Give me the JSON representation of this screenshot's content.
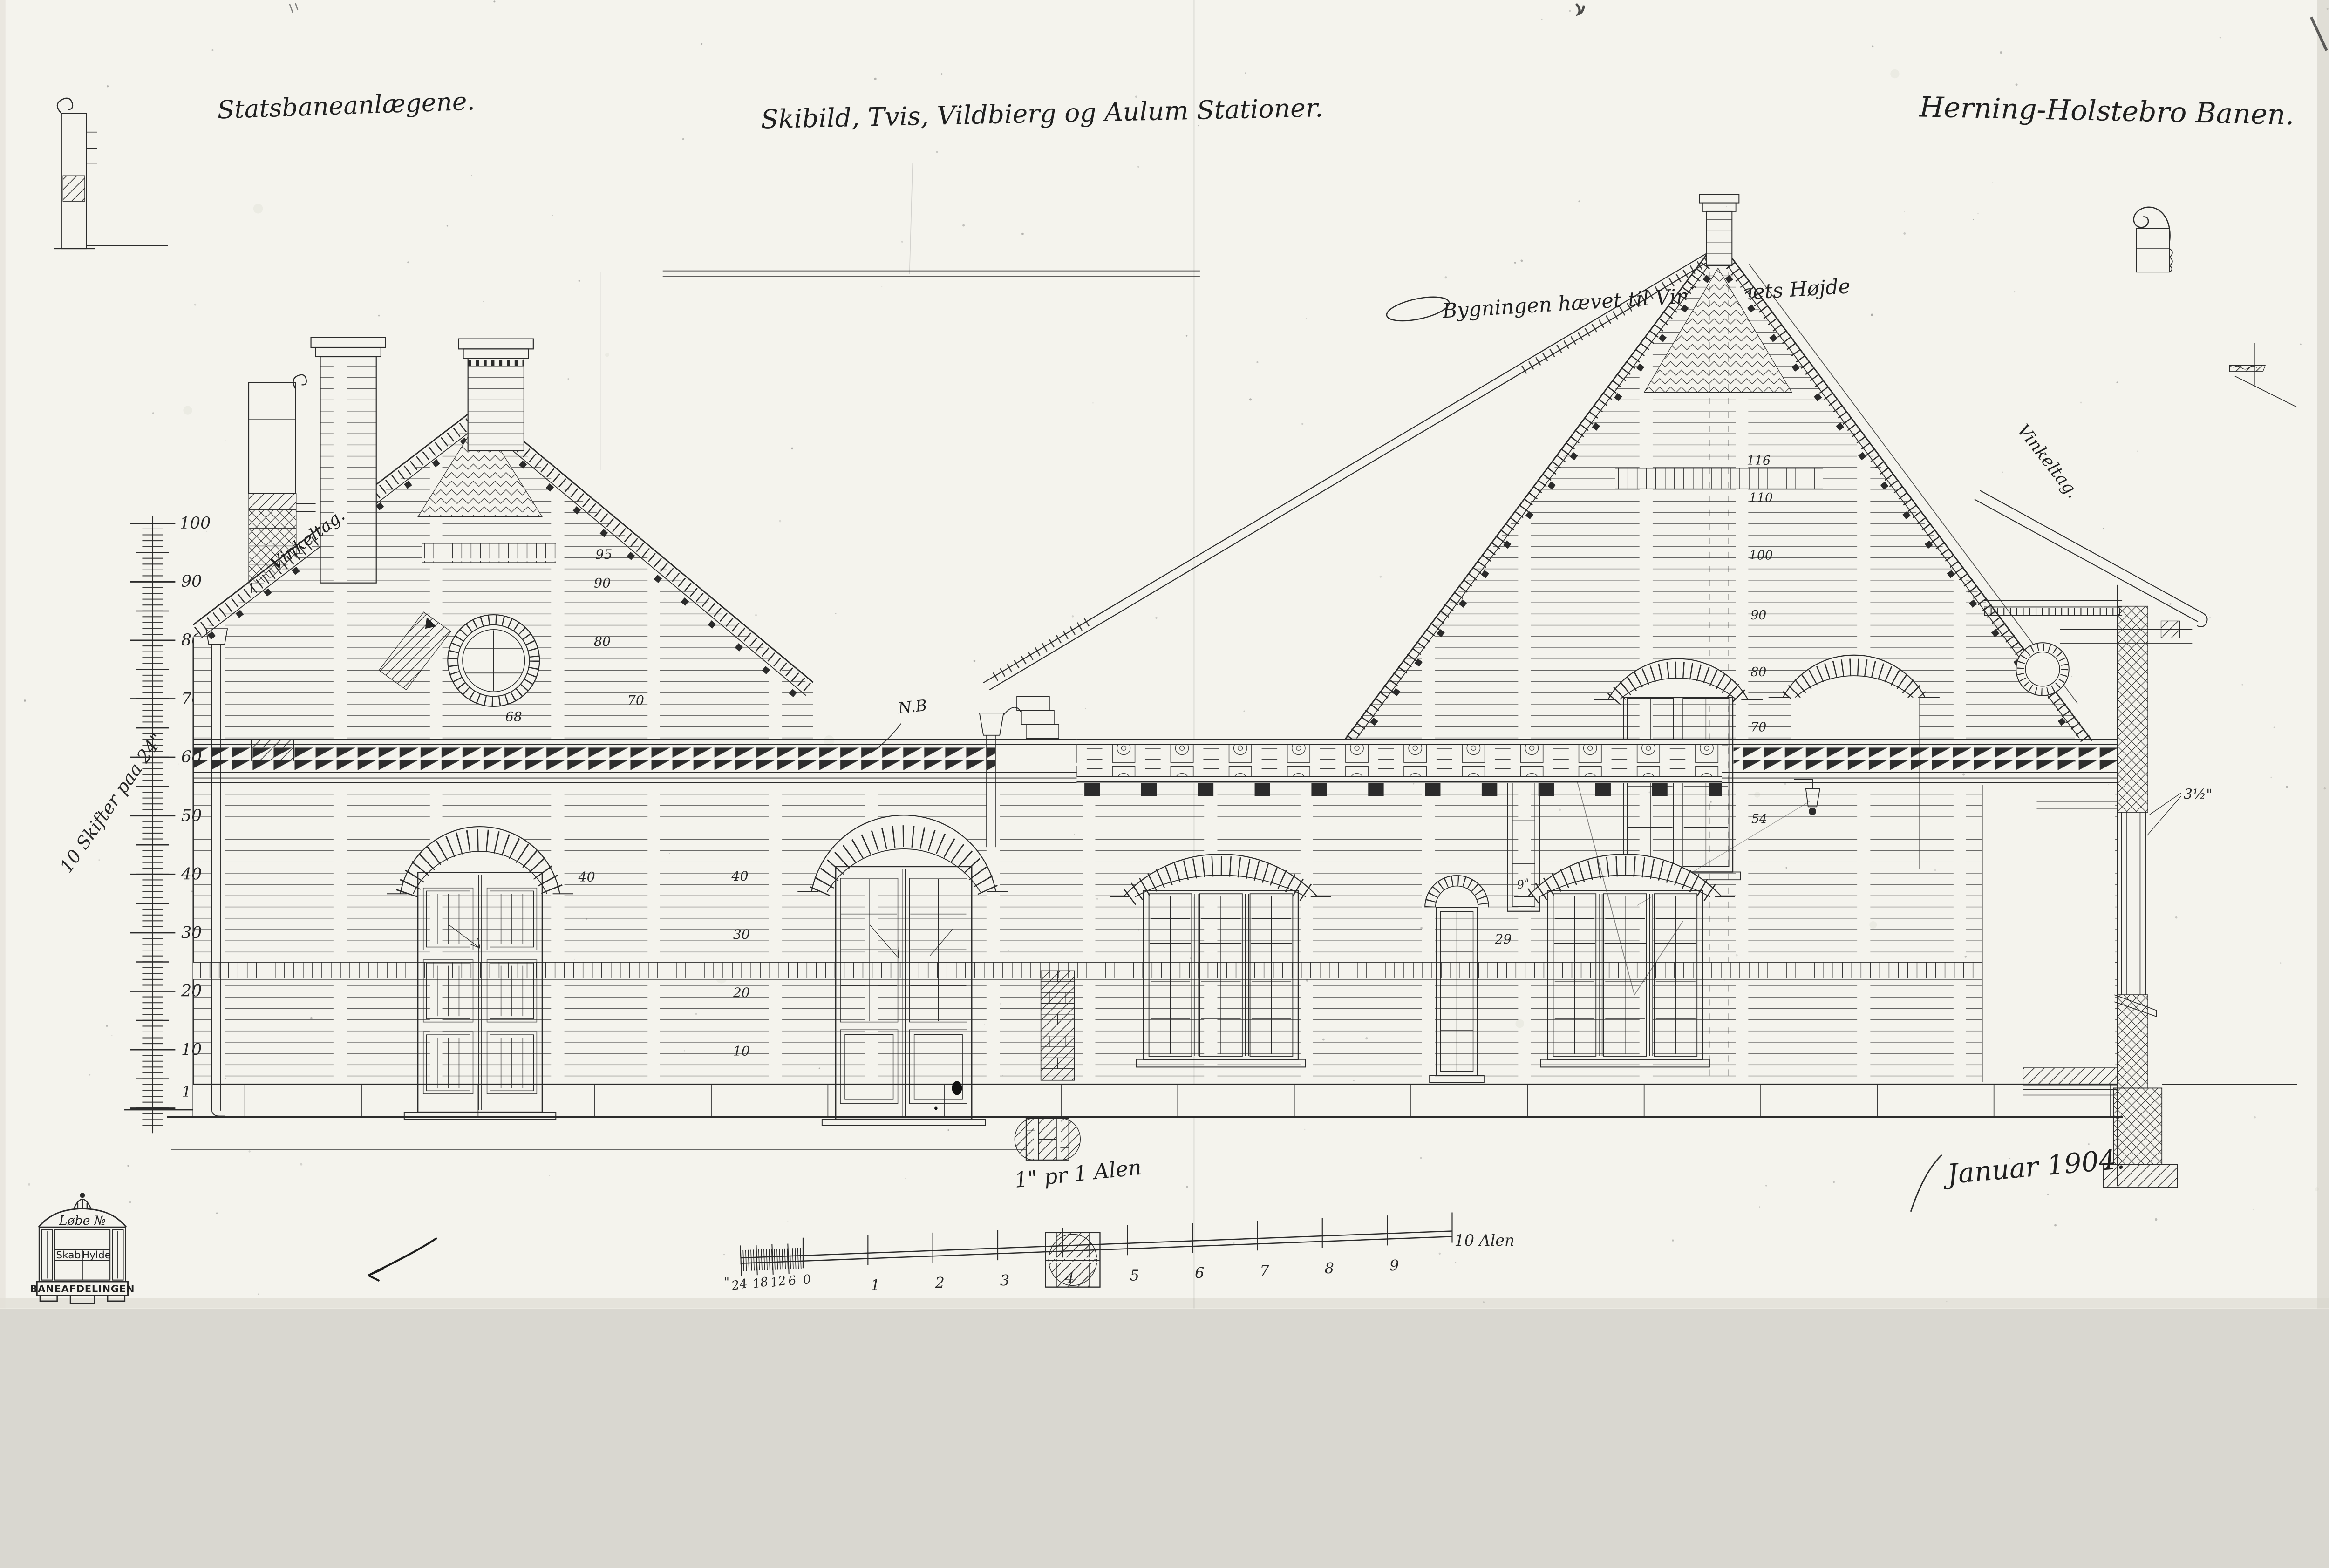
{
  "titles": {
    "left": "Statsbaneanlægene.",
    "center": "Skibild, Tvis, Vildbierg og Aulum Stationer.",
    "right": "Herning-Holstebro Banen."
  },
  "annotations": {
    "raised": "Bygningen hævet til Vinkeltagets Højde",
    "roof_left": "Vinkeltag.",
    "roof_right": "Vinkeltag.",
    "nb": "N.B",
    "scale_note": "1\" pr 1 Alen",
    "date": "Januar 1904."
  },
  "ruler": {
    "note": "10 Skifter paa 24\"",
    "labels": [
      "100",
      "90",
      "80",
      "70",
      "60",
      "50",
      "40",
      "30",
      "20",
      "10",
      "1",
      "0"
    ]
  },
  "scalebar": {
    "inch_mark": "\"",
    "inch": [
      "24",
      "18",
      "12",
      "6",
      "0"
    ],
    "alen": [
      "1",
      "2",
      "3",
      "4",
      "5",
      "6",
      "7",
      "8",
      "9"
    ],
    "end": "10 Alen"
  },
  "numbers": {
    "left_gable": [
      "95",
      "90",
      "80",
      "70",
      "68"
    ],
    "wall": [
      "40",
      "40",
      "30",
      "20",
      "10"
    ],
    "window": "29",
    "lamp": "54",
    "right_gable": [
      "116",
      "110",
      "100",
      "90",
      "80",
      "70"
    ]
  },
  "dims": {
    "frame": "3½\"",
    "side": "9\""
  },
  "stamp": {
    "top": "Løbe №",
    "left": "Skab",
    "right": "Hylde",
    "bottom": "BANEAFDELINGEN"
  },
  "colors": {
    "paper": "#f4f3ed",
    "ink": "#2b2b2b"
  }
}
